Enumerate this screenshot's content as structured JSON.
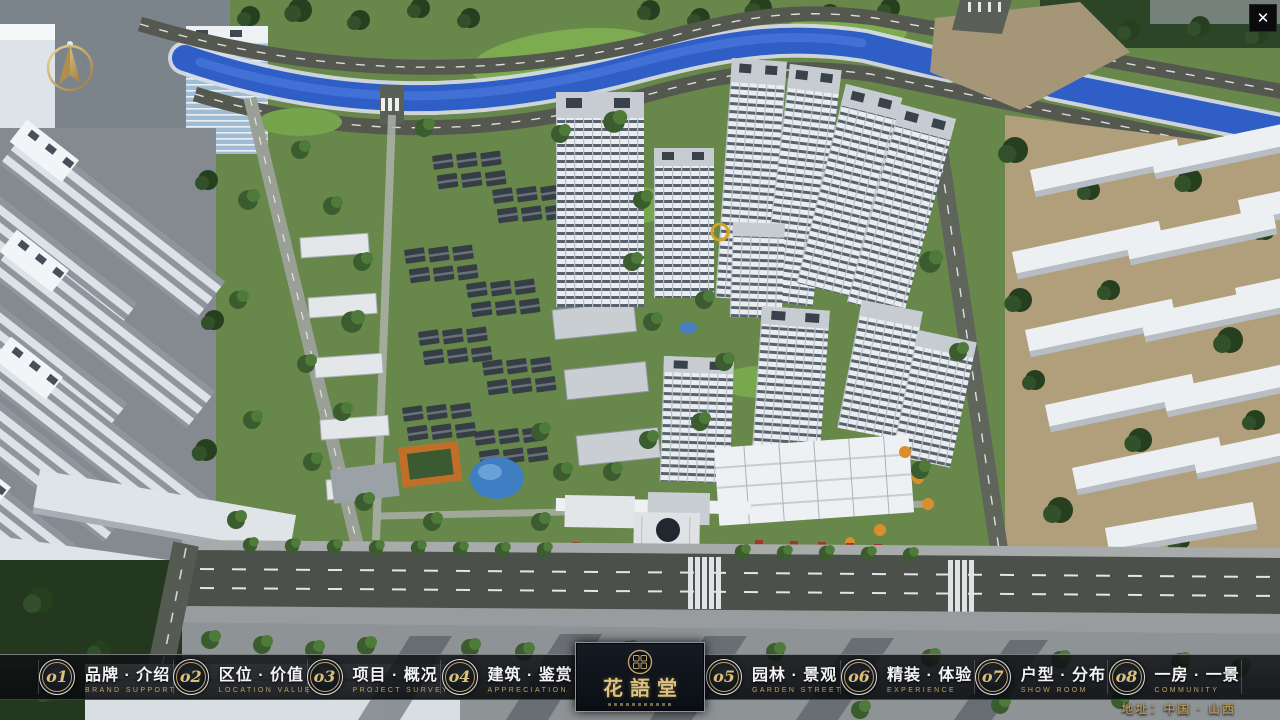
{
  "close": {
    "label": "✕"
  },
  "nav": {
    "items": [
      {
        "num": "o1",
        "zh": "品牌 · 介绍",
        "en": "BRAND SUPPORT"
      },
      {
        "num": "o2",
        "zh": "区位 · 价值",
        "en": "LOCATION VALUE"
      },
      {
        "num": "o3",
        "zh": "项目 · 概况",
        "en": "PROJECT SURVEY"
      },
      {
        "num": "o4",
        "zh": "建筑 · 鉴赏",
        "en": "APPRECIATION"
      },
      {
        "num": "o5",
        "zh": "园林 · 景观",
        "en": "GARDEN STREET"
      },
      {
        "num": "o6",
        "zh": "精装 · 体验",
        "en": "EXPERIENCE"
      },
      {
        "num": "o7",
        "zh": "户型 · 分布",
        "en": "SHOW ROOM"
      },
      {
        "num": "o8",
        "zh": "一房 · 一景",
        "en": "COMMUNITY"
      }
    ]
  },
  "logo": {
    "name": "花語堂"
  },
  "footer": {
    "address": "地址：中国 · 山西"
  },
  "colors": {
    "gold": "#c7a55f",
    "bar_bg": "rgba(10,12,15,0.84)",
    "river_blue": "#2e5ec6",
    "site_green": "#68874a"
  }
}
